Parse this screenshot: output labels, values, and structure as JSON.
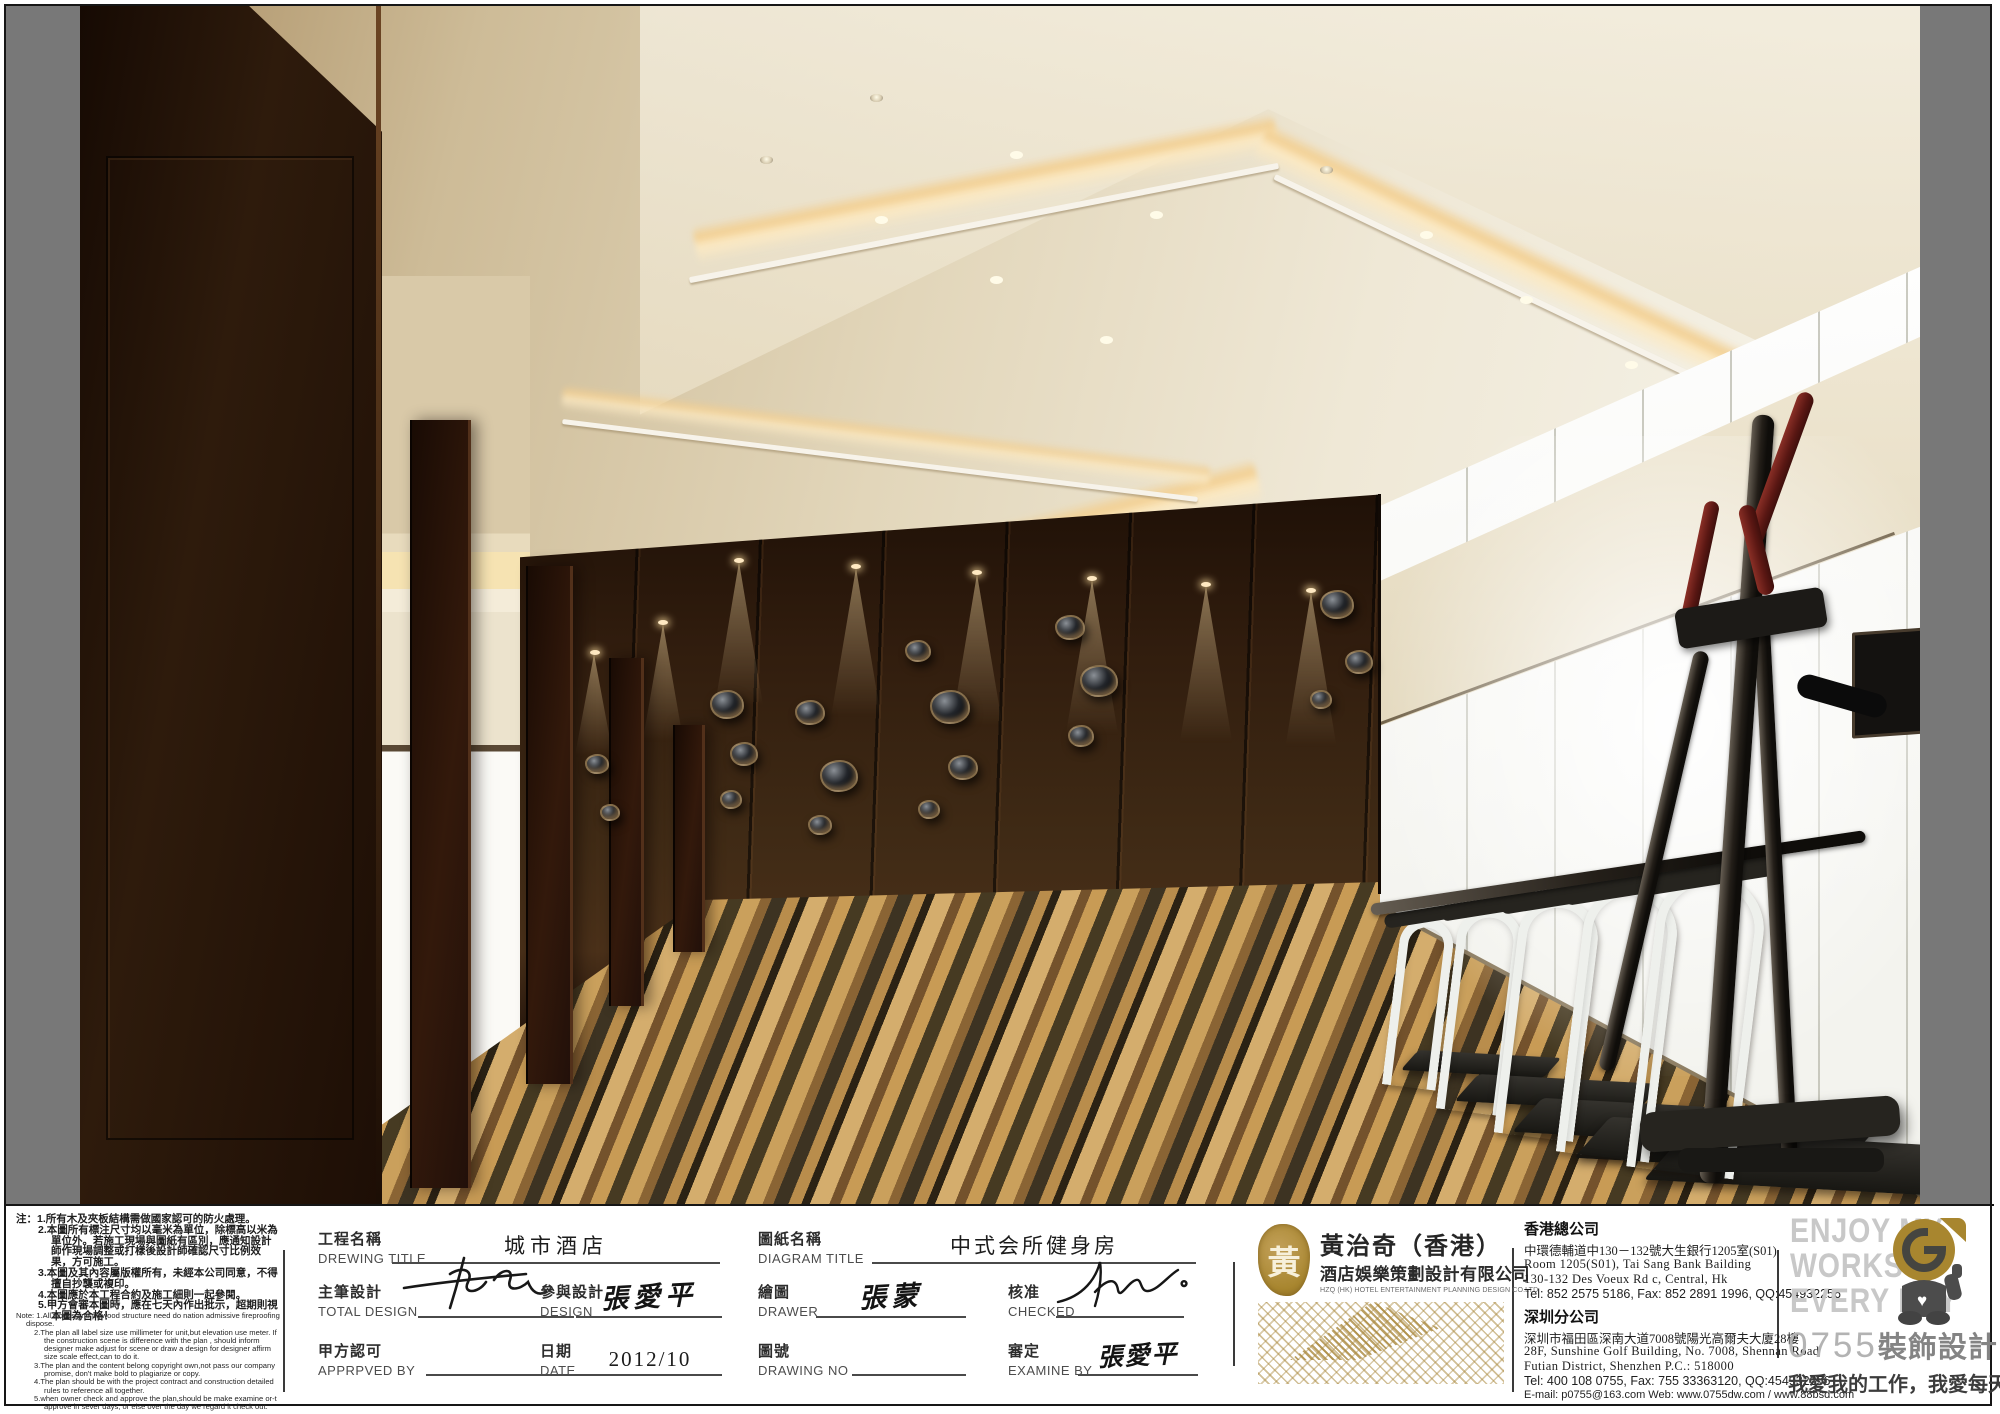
{
  "colors": {
    "frame": "#161616",
    "sheet_white": "#ffffff",
    "letterbox_gray": "#787878",
    "gold_accent": "#a8862f",
    "seal_gold": "#b09045",
    "slogan_gray": "#c8c8c8",
    "tagline_gray": "#3c3c3c",
    "wood_dark": "#2e1b0c",
    "carpet_tan": "#caa05c",
    "ceiling_cream": "#efe8d6",
    "cove_glow": "#f2cf92",
    "machine_red": "#5a1713"
  },
  "notes": {
    "cn": [
      "注：1.所有木及夾板結構需做國家認可的防火處理。",
      "2.本圖所有標注尺寸均以毫米為單位，除標高以米為單位外。若施工現場與圖紙有區別，應通知設計師作現場調整或打樣後設計師確認尺寸比例效果，方可施工。",
      "3.本圖及其內容屬版權所有，未經本公司同意，不得擅自抄襲或複印。",
      "4.本圖應於本工程合約及施工細則一起參閱。",
      "5.甲方會審本圖時，應在七天內作出批示，超期則視本圖為合格！"
    ],
    "en": [
      "Note: 1.All woods and plywood structure need do nation admissive fireproofing dispose.",
      "2.The plan all label size use millimeter for unit,but elevation use meter. If the construction scene is difference with the plan , should inform designer make adjust for scene or draw a design for designer affirm size scale effect,can to do it.",
      "3.The plan and the content belong copyright own,not pass our company promise, don't make bold to plagiarize or copy.",
      "4.The plan should be with the project contract and construction detailed rules to reference all together.",
      "5.when owner check and approve the plan,should be make examine or-t approve in sever days, or else over the day we regard it check out."
    ]
  },
  "fields": {
    "drawing_title": {
      "label_cn": "工程名稱",
      "label_en": "DREWING TITLE",
      "value": "城市酒店"
    },
    "diagram_title": {
      "label_cn": "圖紙名稱",
      "label_en": "DIAGRAM TITLE",
      "value": "中式会所健身房"
    },
    "total_design": {
      "label_cn": "主筆設計",
      "label_en": "TOTAL DESIGN",
      "value": ""
    },
    "design": {
      "label_cn": "參與設計",
      "label_en": "DESIGN",
      "value": "張愛平"
    },
    "drawer": {
      "label_cn": "繪圖",
      "label_en": "DRAWER",
      "value": "張蒙"
    },
    "checked": {
      "label_cn": "核准",
      "label_en": "CHECKED",
      "value": ""
    },
    "approved": {
      "label_cn": "甲方認可",
      "label_en": "APPRPVED BY",
      "value": ""
    },
    "date": {
      "label_cn": "日期",
      "label_en": "DATE",
      "value": "2012/10"
    },
    "drawing_no": {
      "label_cn": "圖號",
      "label_en": "DRAWING NO",
      "value": ""
    },
    "examine": {
      "label_cn": "審定",
      "label_en": "EXAMINE BY",
      "value": "張愛平"
    }
  },
  "company": {
    "seal_char": "黃",
    "name_cn": "黃治奇（香港）",
    "name_sub": "酒店娛樂策劃設計有限公司",
    "name_en": "HZQ (HK) HOTEL ENTERTAINMENT PLANNING DESIGN CO.LTD"
  },
  "offices": {
    "hk": {
      "title": "香港總公司",
      "lines": [
        "中環德輔道中130－132號大生銀行1205室(S01)",
        "Room 1205(S01), Tai Sang Bank Bailding",
        "130-132 Des Voeux Rd c, Central, Hk",
        "Tel: 852 2575 5186, Fax: 852 2891 1996, QQ:454932256"
      ]
    },
    "sz": {
      "title": "深圳分公司",
      "lines": [
        "深圳市福田區深南大道7008號陽光高爾夫大廈28樓",
        "28F, Sunshine Golf Building, No. 7008, Shennan Road",
        "Futian District, Shenzhen  P.C.: 518000",
        "Tel: 400 108 0755,  Fax: 755 33363120, QQ:454932256",
        "E-mail: p0755@163.com   Web: www.0755dw.com / www.88bsd.com"
      ]
    }
  },
  "branding": {
    "slogan_lines": [
      "ENJOY MY",
      "WORKS",
      "EVERY DAY"
    ],
    "brand_number": "0755",
    "brand_name": "裝飾設計",
    "tagline": "我愛我的工作，我愛每天創作"
  }
}
